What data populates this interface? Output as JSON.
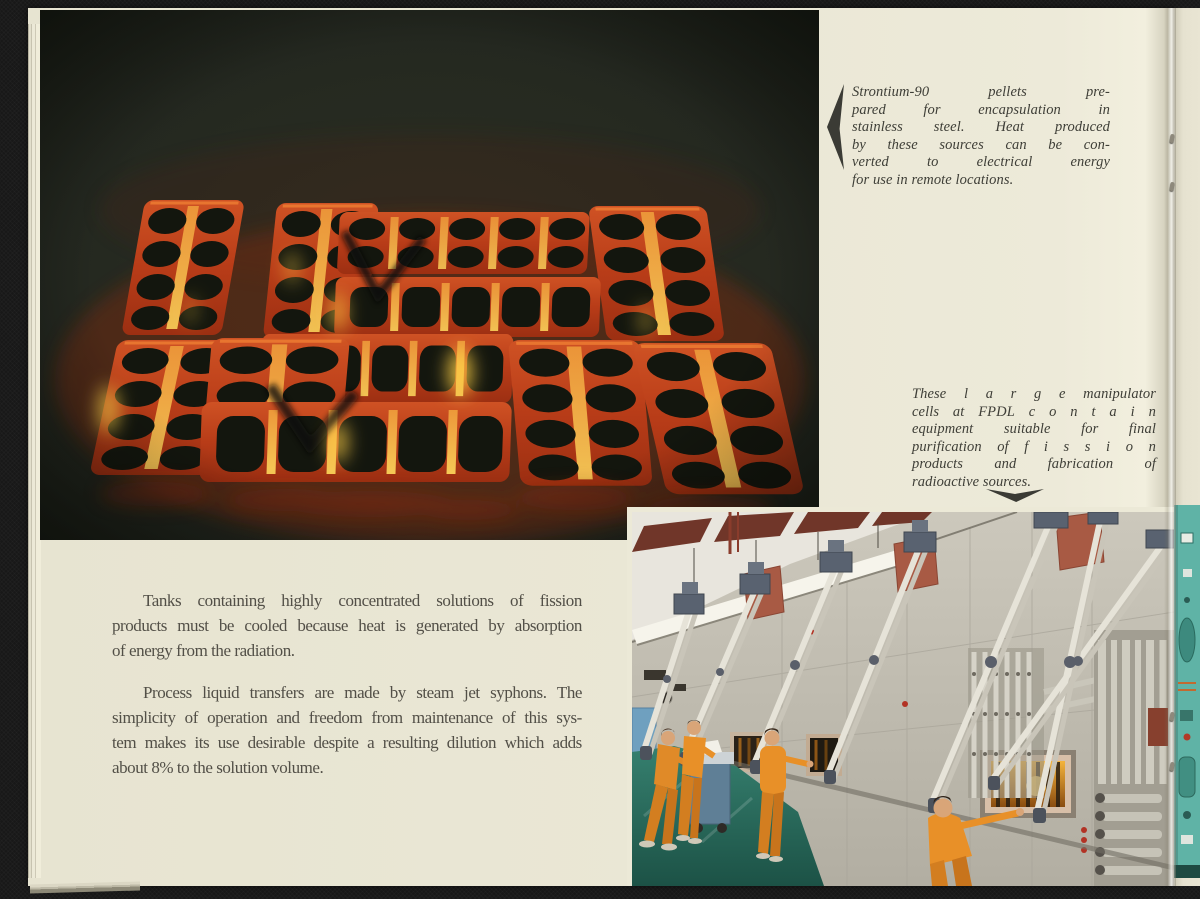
{
  "page": {
    "type": "scanned-book-page",
    "captions": {
      "strontium": {
        "lines": [
          "Strontium-90 pellets pre-",
          "pared for encapsulation in",
          "stainless steel. Heat produced",
          "by these sources can be con-",
          "verted to electrical energy",
          "for use in remote locations."
        ]
      },
      "manipulator": {
        "lines": [
          "These l a r g e manipulator",
          "cells at FPDL c o n t a i n",
          "equipment suitable for final",
          "purification of f i s s i o n",
          "products and fabrication of",
          "radioactive sources."
        ]
      }
    },
    "body": {
      "paragraphs": [
        {
          "lines": [
            "Tanks containing highly concentrated solutions of fission",
            "products must be cooled because heat is generated by absorption",
            "of energy from the radiation."
          ]
        },
        {
          "lines": [
            "Process liquid transfers are made by steam jet syphons. The",
            "simplicity of operation and freedom from maintenance of this sys-",
            "tem makes its use desirable despite a resulting dilution which adds",
            "about 8% to the solution volume."
          ]
        }
      ]
    },
    "figures": {
      "pellet_trays": {
        "alt": "Glowing red-hot trays of Strontium-90 pellets photographed in a dark hot cell"
      },
      "manipulator_cells": {
        "alt": "Technicians in orange coveralls operating master-slave manipulators along a shielded hot-cell wall with amber viewing windows"
      }
    },
    "icons": {
      "left_arrow": "left-pointer",
      "down_arrow": "down-pointer"
    },
    "colors": {
      "background": "#181818",
      "paper": "#eae7d5",
      "ink": "#524f47",
      "caption_ink": "#3e3e37",
      "arrow": "#3b3b35",
      "photo_dark_bg": "#242820",
      "tray_orange": "#b83c18",
      "glow_yellow": "#ffd047",
      "floor_teal": "#2d6e5c",
      "suit_orange": "#e08a28",
      "next_page_teal": "#5fb3a6"
    }
  }
}
